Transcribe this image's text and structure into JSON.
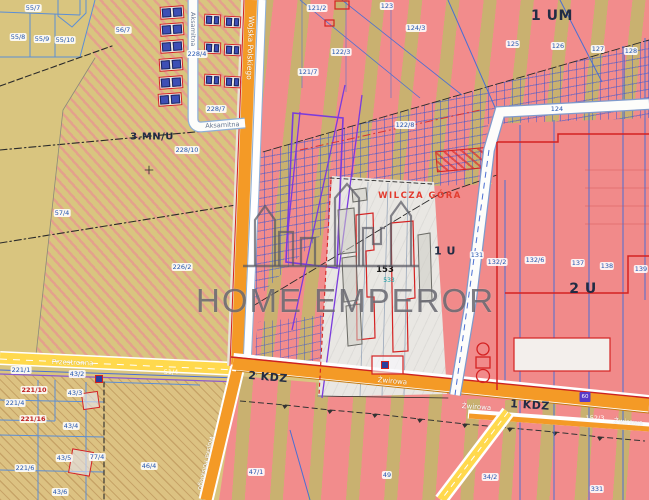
{
  "watermark": {
    "brand": "HOME EMPEROR"
  },
  "zones": {
    "um1": "1 UM",
    "mnu3": "3.MN/U",
    "u2": "2 U",
    "u1": "1 U",
    "kdz2": "2 KDZ",
    "kdz1": "1 KDZ",
    "locality": "WILCZA GÓRA"
  },
  "streets": {
    "wojska_polskiego": "Wojska Polskiego",
    "wojska_polskiego_south": "Wojska Polskiego",
    "aksamitna_vertical": "Aksamitna",
    "aksamitna_horizontal": "Aksamitna",
    "przestronna": "Przestronna",
    "zwirowa_west": "Żwirowa",
    "zwirowa_mid": "Żwirowa",
    "zwirowa_east": "Żwirowa"
  },
  "parcel_numbers": [
    {
      "id": "55/7",
      "x": 33,
      "y": 8,
      "style": "blue"
    },
    {
      "id": "55/8",
      "x": 18,
      "y": 37,
      "style": "blue"
    },
    {
      "id": "55/9",
      "x": 42,
      "y": 39,
      "style": "blue"
    },
    {
      "id": "55/10",
      "x": 65,
      "y": 40,
      "style": "blue"
    },
    {
      "id": "56/7",
      "x": 123,
      "y": 30,
      "style": "blue"
    },
    {
      "id": "228/4",
      "x": 197,
      "y": 54,
      "style": "blue"
    },
    {
      "id": "228/7",
      "x": 216,
      "y": 109,
      "style": "blue"
    },
    {
      "id": "228/10",
      "x": 187,
      "y": 150,
      "style": "blue"
    },
    {
      "id": "226/2",
      "x": 182,
      "y": 267,
      "style": "blue"
    },
    {
      "id": "57/4",
      "x": 62,
      "y": 213,
      "style": "blue"
    },
    {
      "id": "121/2",
      "x": 317,
      "y": 8,
      "style": "blue"
    },
    {
      "id": "123",
      "x": 387,
      "y": 6,
      "style": "blue"
    },
    {
      "id": "124/3",
      "x": 416,
      "y": 28,
      "style": "blue"
    },
    {
      "id": "122/3",
      "x": 341,
      "y": 52,
      "style": "blue"
    },
    {
      "id": "121/7",
      "x": 308,
      "y": 72,
      "style": "blue"
    },
    {
      "id": "122/8",
      "x": 405,
      "y": 125,
      "style": "blue"
    },
    {
      "id": "125",
      "x": 513,
      "y": 44,
      "style": "blue"
    },
    {
      "id": "126",
      "x": 558,
      "y": 46,
      "style": "blue"
    },
    {
      "id": "127",
      "x": 598,
      "y": 49,
      "style": "blue"
    },
    {
      "id": "128",
      "x": 631,
      "y": 51,
      "style": "blue"
    },
    {
      "id": "124",
      "x": 557,
      "y": 109,
      "style": "blue"
    },
    {
      "id": "131",
      "x": 477,
      "y": 255,
      "style": "blue"
    },
    {
      "id": "132/2",
      "x": 497,
      "y": 262,
      "style": "blue"
    },
    {
      "id": "132/6",
      "x": 535,
      "y": 260,
      "style": "blue"
    },
    {
      "id": "137",
      "x": 578,
      "y": 263,
      "style": "blue"
    },
    {
      "id": "138",
      "x": 607,
      "y": 266,
      "style": "blue"
    },
    {
      "id": "139",
      "x": 641,
      "y": 269,
      "style": "blue"
    },
    {
      "id": "153",
      "x": 385,
      "y": 270,
      "style": "dark"
    },
    {
      "id": "533",
      "x": 389,
      "y": 281,
      "style": "teal"
    },
    {
      "id": "51/4",
      "x": 171,
      "y": 372,
      "style": "road"
    },
    {
      "id": "221/1",
      "x": 21,
      "y": 370,
      "style": "blue"
    },
    {
      "id": "43/2",
      "x": 77,
      "y": 374,
      "style": "blue"
    },
    {
      "id": "43/3",
      "x": 75,
      "y": 393,
      "style": "blue"
    },
    {
      "id": "221/4",
      "x": 15,
      "y": 403,
      "style": "blue"
    },
    {
      "id": "221/10",
      "x": 34,
      "y": 390,
      "style": "red"
    },
    {
      "id": "221/16",
      "x": 33,
      "y": 419,
      "style": "red"
    },
    {
      "id": "43/4",
      "x": 71,
      "y": 426,
      "style": "blue"
    },
    {
      "id": "43/5",
      "x": 64,
      "y": 458,
      "style": "blue"
    },
    {
      "id": "43/6",
      "x": 60,
      "y": 492,
      "style": "blue"
    },
    {
      "id": "221/6",
      "x": 25,
      "y": 468,
      "style": "blue"
    },
    {
      "id": "77/4",
      "x": 97,
      "y": 457,
      "style": "blue"
    },
    {
      "id": "46/4",
      "x": 149,
      "y": 466,
      "style": "blue"
    },
    {
      "id": "47/1",
      "x": 256,
      "y": 472,
      "style": "blue"
    },
    {
      "id": "49",
      "x": 387,
      "y": 475,
      "style": "blue"
    },
    {
      "id": "34/2",
      "x": 490,
      "y": 477,
      "style": "blue"
    },
    {
      "id": "331",
      "x": 597,
      "y": 489,
      "style": "blue"
    },
    {
      "id": "152/3",
      "x": 595,
      "y": 418,
      "style": "road"
    },
    {
      "id": "60",
      "x": 585,
      "y": 397,
      "style": "purple"
    }
  ],
  "colors": {
    "zone_stripe_pink": "#f28c8c",
    "zone_stripe_tan": "#c9b170",
    "base_tan": "#d9c57f",
    "road_orange": "#f49a26",
    "road_yellow": "#ffd94d",
    "red_border": "#d42222",
    "utility_blue": "#4a6fd4",
    "utility_purple": "#7a3bdd",
    "watermark_gray": "#58585f"
  }
}
